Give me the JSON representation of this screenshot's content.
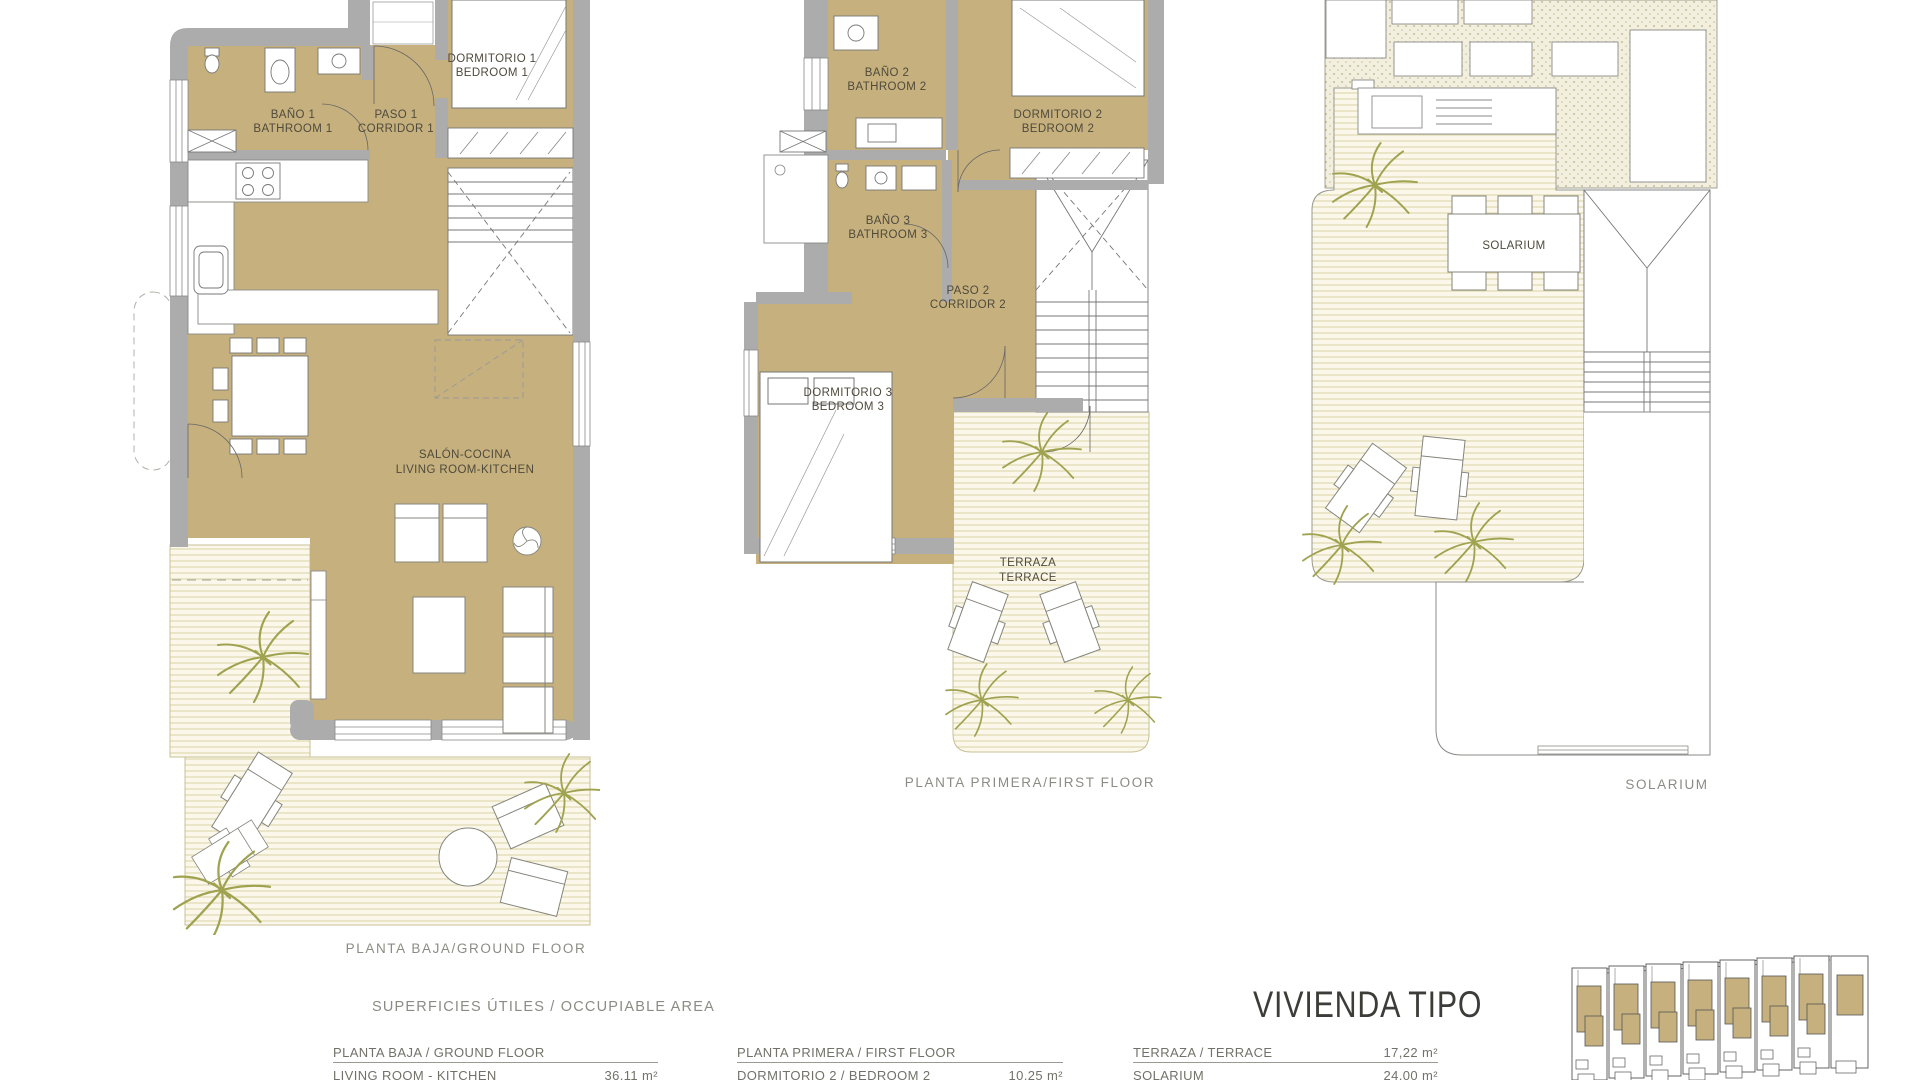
{
  "colors": {
    "beige": "#C6B17E",
    "wall": "#ACACAC",
    "deck_bg": "#FBF8EB",
    "deck_line": "#DBD2A6",
    "gravel_bg": "#F3EFDE",
    "gravel_dot": "#C6BD94",
    "palm": "#9FA24F",
    "label": "#4F4A3C",
    "caption": "#8C8C84",
    "table_text": "#72726A",
    "title_text": "#3C3C38",
    "line": "#777770"
  },
  "plans": {
    "ground": {
      "caption": "PLANTA BAJA/GROUND FLOOR",
      "rooms": {
        "bano1": {
          "es": "BAÑO 1",
          "en": "BATHROOM 1"
        },
        "paso1": {
          "es": "PASO 1",
          "en": "CORRIDOR 1"
        },
        "dormitorio1": {
          "es": "DORMITORIO 1",
          "en": "BEDROOM 1"
        },
        "salon": {
          "es": "SALÓN-COCINA",
          "en": "LIVING ROOM-KITCHEN"
        }
      }
    },
    "first": {
      "caption": "PLANTA PRIMERA/FIRST FLOOR",
      "rooms": {
        "bano2": {
          "es": "BAÑO 2",
          "en": "BATHROOM 2"
        },
        "dormitorio2": {
          "es": "DORMITORIO 2",
          "en": "BEDROOM 2"
        },
        "bano3": {
          "es": "BAÑO 3",
          "en": "BATHROOM 3"
        },
        "paso2": {
          "es": "PASO 2",
          "en": "CORRIDOR 2"
        },
        "dormitorio3": {
          "es": "DORMITORIO 3",
          "en": "BEDROOM 3"
        },
        "terraza": {
          "es": "TERRAZA",
          "en": "TERRACE"
        }
      }
    },
    "solarium": {
      "caption": "SOLARIUM",
      "room_label": "SOLARIUM"
    }
  },
  "summary": {
    "heading": "SUPERFICIES ÚTILES / OCCUPIABLE AREA",
    "title": "VIVIENDA TIPO",
    "tables": [
      {
        "header": "PLANTA BAJA / GROUND FLOOR",
        "rows": [
          {
            "label": "LIVING ROOM - KITCHEN",
            "value": "36,11 m²"
          }
        ]
      },
      {
        "header": "PLANTA PRIMERA / FIRST FLOOR",
        "rows": [
          {
            "label": "DORMITORIO 2 / BEDROOM 2",
            "value": "10,25 m²"
          }
        ]
      },
      {
        "header": "",
        "rows": [
          {
            "label": "TERRAZA / TERRACE",
            "value": "17,22 m²"
          },
          {
            "label": "SOLARIUM",
            "value": "24,00 m²"
          }
        ]
      }
    ]
  }
}
